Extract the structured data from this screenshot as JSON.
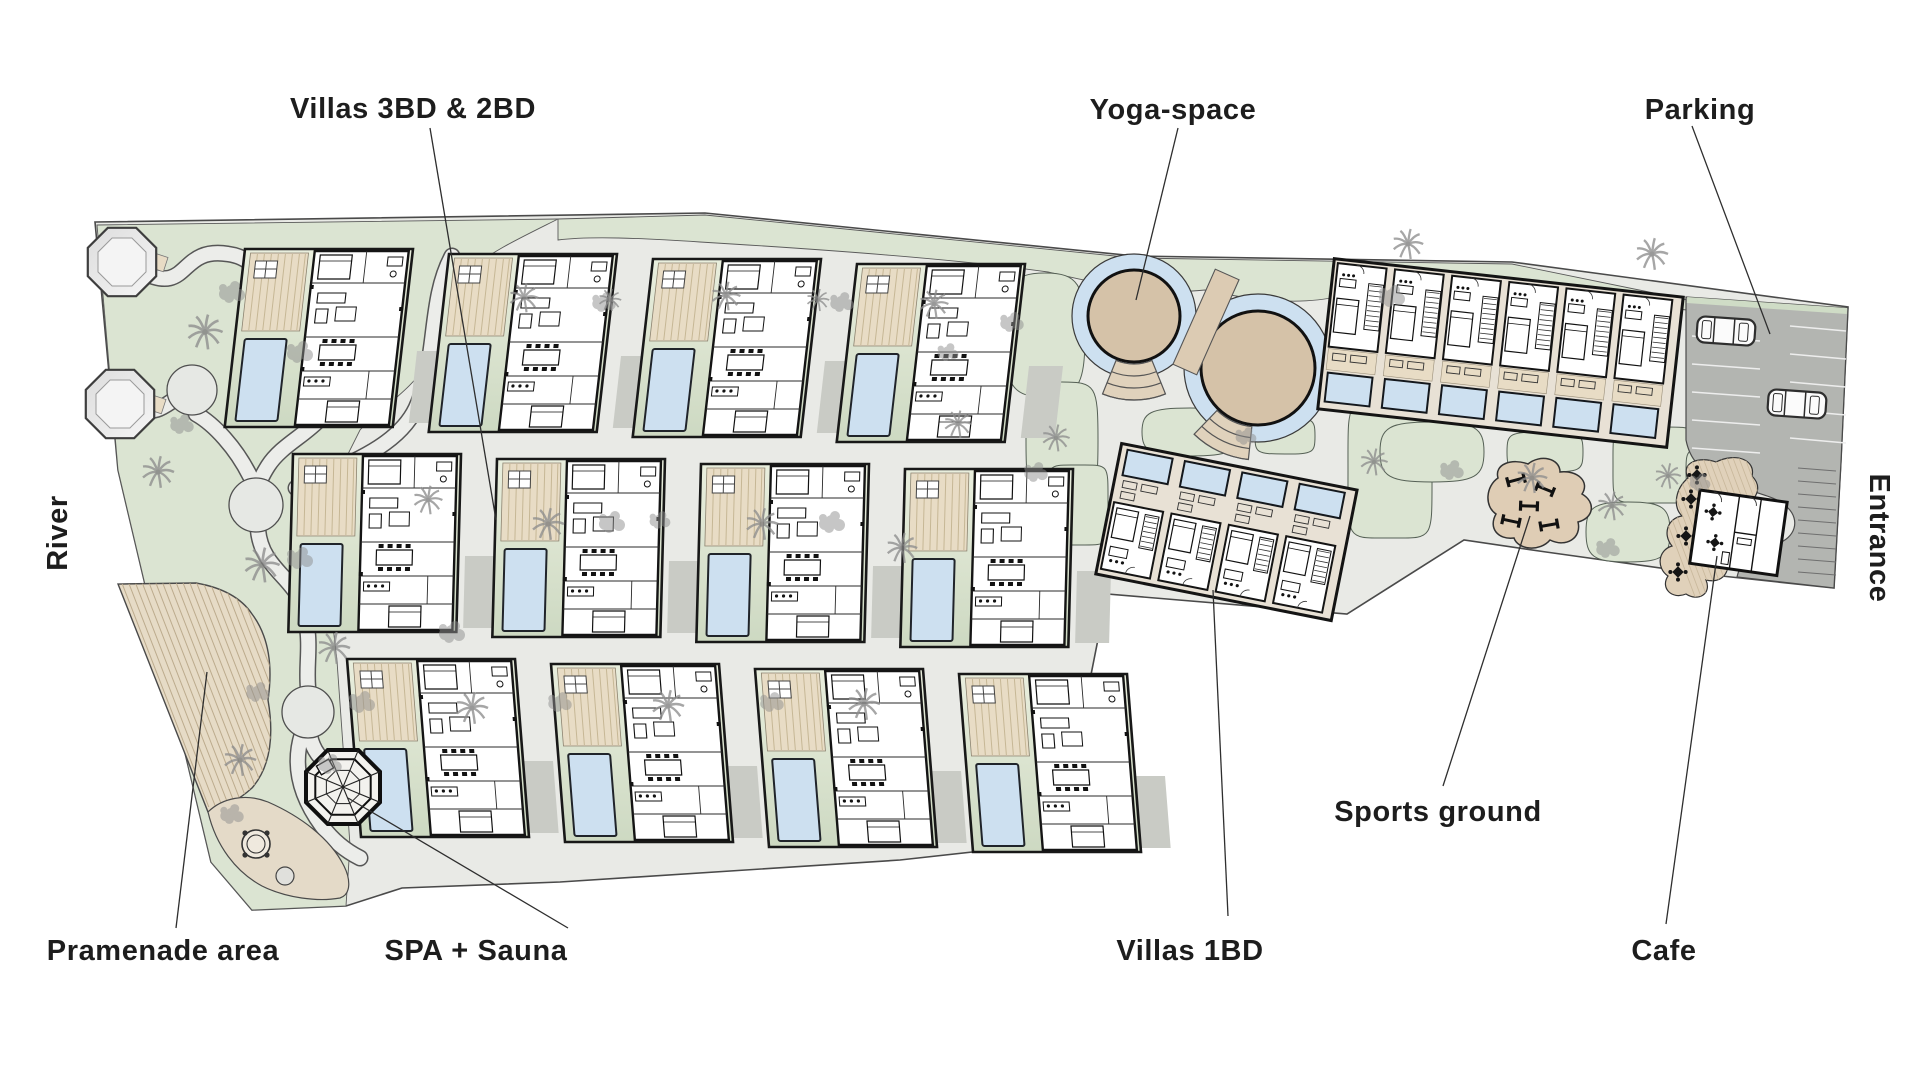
{
  "plan": {
    "labels": {
      "villas_3bd_2bd": "Villas 3BD & 2BD",
      "yoga_space": "Yoga-space",
      "parking": "Parking",
      "river": "River",
      "entrance": "Entrance",
      "promenade": "Pramenade area",
      "spa_sauna": "SPA + Sauna",
      "villas_1bd": "Villas 1BD",
      "sports_ground": "Sports ground",
      "cafe": "Cafe"
    },
    "features": {
      "villas_3bd_2bd_count": 12,
      "villas_1bd_row_count": 6,
      "villas_1bd_block_count": 4,
      "yoga_circles_count": 2,
      "gazebo_count": 2,
      "parked_cars_count": 2,
      "spa_structures_count": 1
    },
    "colors": {
      "park_green": "#dbe4d2",
      "plot_green_light": "#e9eedd",
      "plot_green_dark": "#cdd9c2",
      "road_gray": "#e9eae6",
      "driveway_gray": "#c9cbc5",
      "parking_gray": "#b3b5b1",
      "deck_tan": "#e8dcc5",
      "yoga_tan": "#d5c2a8",
      "pool_blue": "#cde0f0",
      "outline_black": "#161616",
      "tree_gray": "#969696",
      "label_color": "#1d1d1d",
      "background": "#ffffff"
    }
  }
}
